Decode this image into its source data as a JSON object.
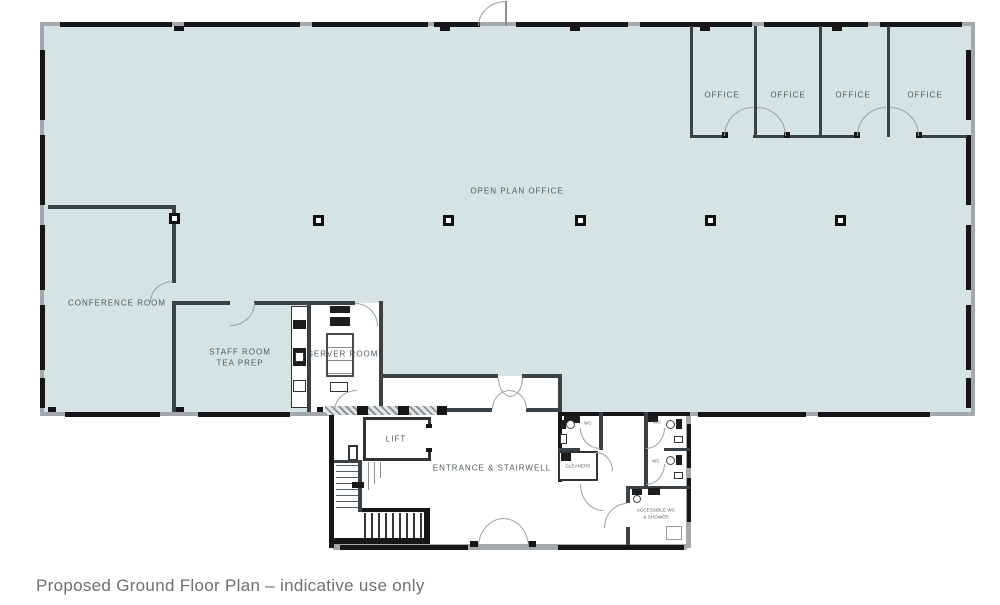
{
  "meta": {
    "caption": "Proposed Ground Floor Plan – indicative use only"
  },
  "colors": {
    "floor": "#d5e3e5",
    "wall_dark": "#3a4247",
    "wall_black": "#161616",
    "ext": "#a2a8ab",
    "label": "#50585c",
    "caption": "#6f6f6f",
    "door": "#9aa0a3"
  },
  "rooms": {
    "open_plan_office": "OPEN PLAN OFFICE",
    "conference_room": "CONFERENCE ROOM",
    "staff_room_line1": "STAFF ROOM",
    "staff_room_line2": "TEA PREP",
    "server_room": "SERVER ROOM",
    "lift": "LIFT",
    "entrance": "ENTRANCE & STAIRWELL",
    "offices": [
      "OFFICE",
      "OFFICE",
      "OFFICE",
      "OFFICE"
    ],
    "wc1": "WC",
    "wc2": "WC",
    "wc3": "WC",
    "cleaners": "CLEANERS",
    "accessible_line1": "ACCESSIBLE WC",
    "accessible_line2": "& SHOWER"
  }
}
